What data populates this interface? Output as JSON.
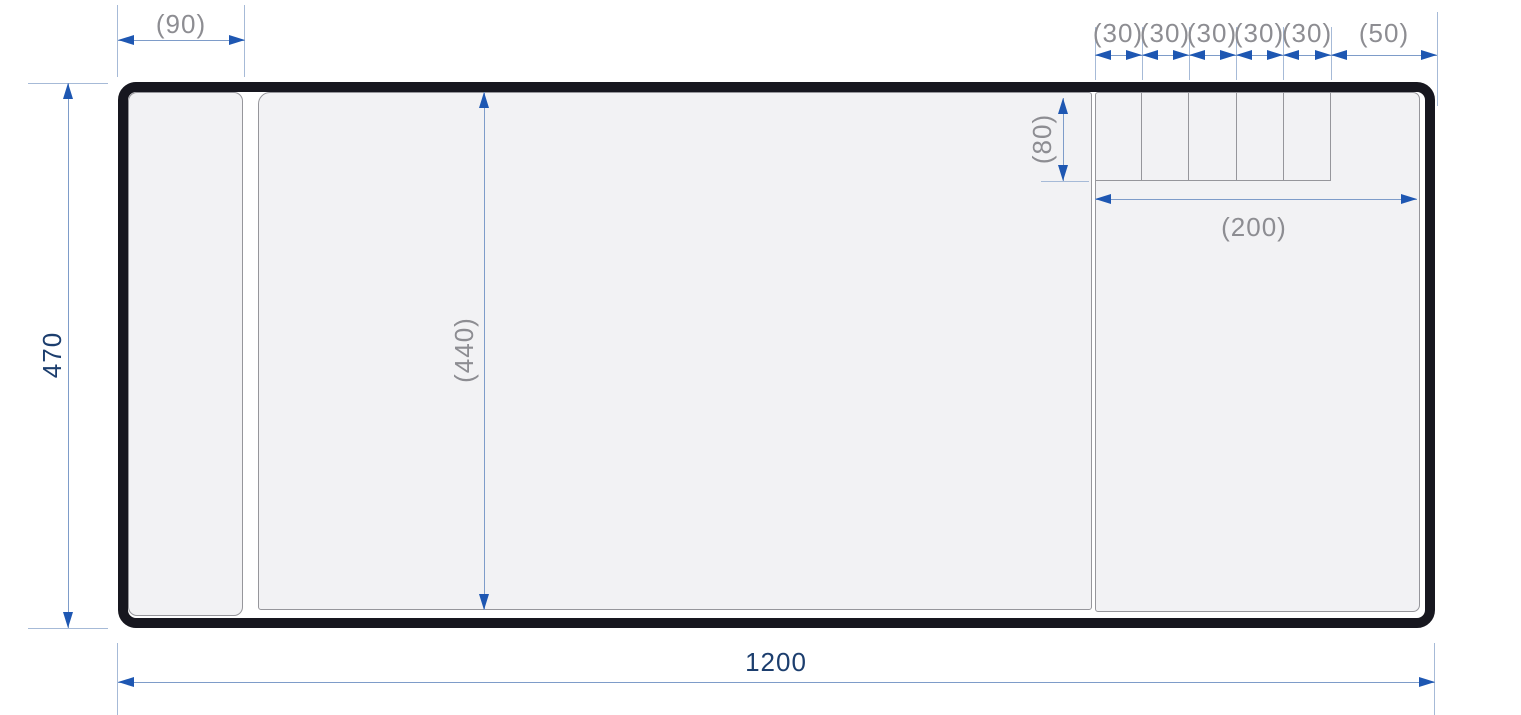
{
  "drawing": {
    "kind": "dimensioned-plan-view",
    "labels": {
      "left_section_width": "(90)",
      "compartment_row": [
        "(30)",
        "(30)",
        "(30)",
        "(30)",
        "(30)"
      ],
      "right_end_width": "(50)",
      "compartment_height": "(80)",
      "right_section_width": "(200)",
      "inner_height": "(440)",
      "overall_height": "470",
      "overall_width": "1200"
    },
    "colors": {
      "outline": "#17171f",
      "panel_fill": "#f2f2f4",
      "panel_border": "#96969b",
      "dimension_line": "#7e9cc9",
      "extension_line": "#a6bad7",
      "arrowhead": "#1e57b2",
      "reference_text": "#8d8d92",
      "primary_text": "#1c3e6e"
    }
  }
}
